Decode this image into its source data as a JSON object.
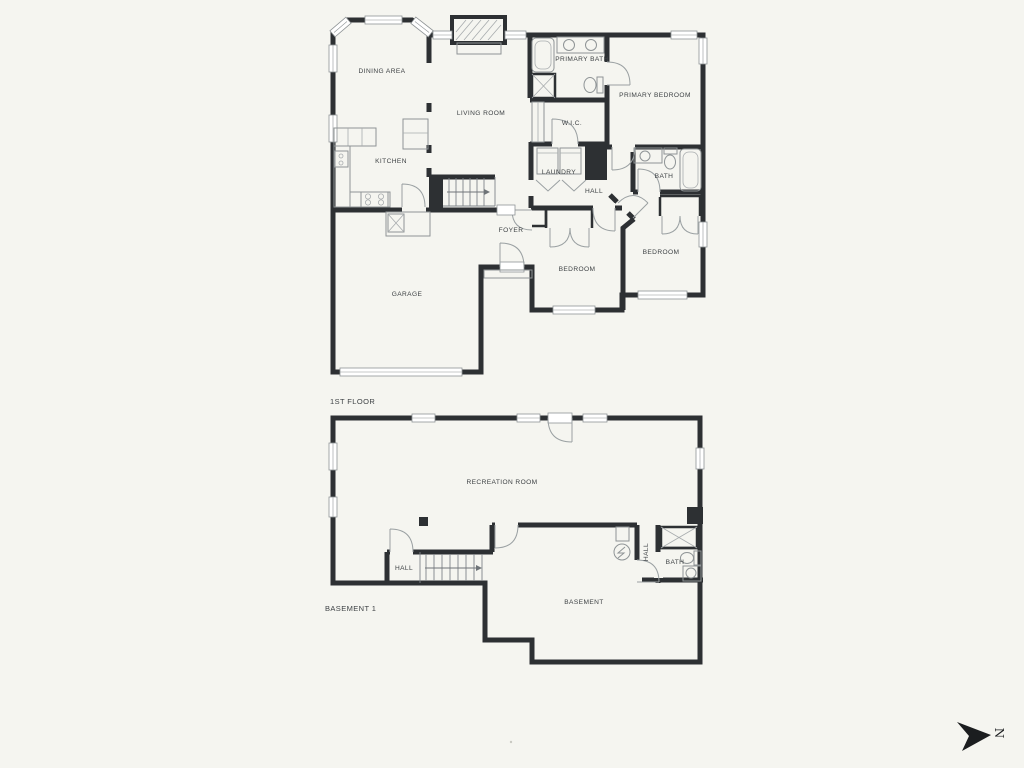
{
  "page": {
    "background": "#f5f5f0"
  },
  "palette": {
    "wall": "#2d3033",
    "fixture_line": "#8f9496",
    "door_arc": "#9aa0a2",
    "label_text": "#3e4245",
    "window_fill": "#ffffff"
  },
  "floor1": {
    "title": "1ST FLOOR",
    "rooms": {
      "dining": "DINING AREA",
      "living": "LIVING ROOM",
      "kitchen": "KITCHEN",
      "primary_bath": "PRIMARY BATH",
      "wic": "W.I.C.",
      "primary_bedroom": "PRIMARY BEDROOM",
      "laundry": "LAUNDRY",
      "hall": "HALL",
      "bath": "BATH",
      "foyer": "FOYER",
      "garage": "GARAGE",
      "bedroom_a": "BEDROOM",
      "bedroom_b": "BEDROOM"
    }
  },
  "basement": {
    "title": "BASEMENT 1",
    "rooms": {
      "recreation": "RECREATION ROOM",
      "hall_stairs": "HALL",
      "hall_bath": "HALL",
      "bath": "BATH",
      "storage": "BASEMENT"
    }
  },
  "compass": {
    "label": "N"
  }
}
